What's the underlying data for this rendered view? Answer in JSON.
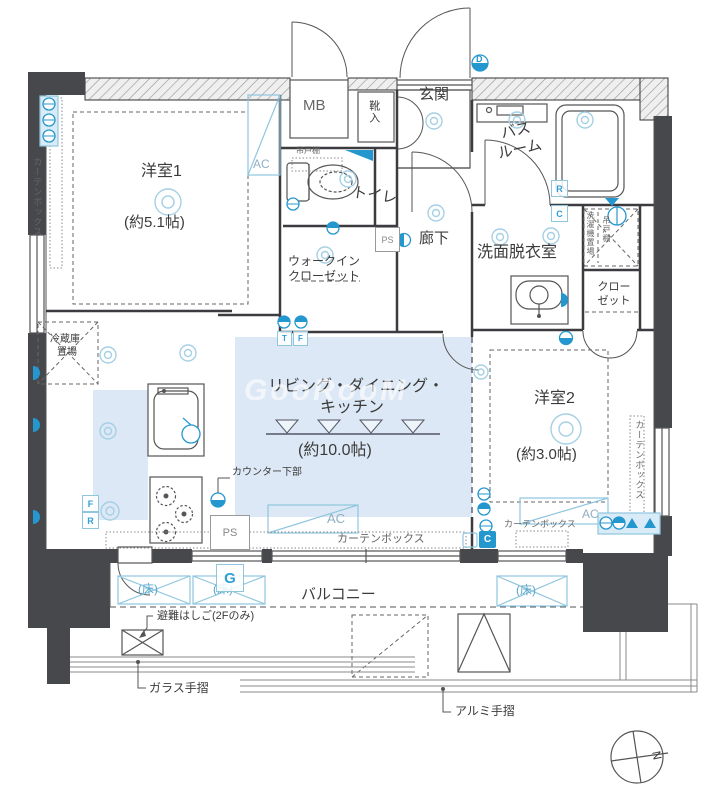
{
  "rooms": {
    "yoshitsu1": {
      "name": "洋室1",
      "size": "(約5.1帖)"
    },
    "yoshitsu2": {
      "name": "洋室2",
      "size": "(約3.0帖)"
    },
    "ldk": {
      "line1": "リビング・ダイニング・",
      "line2": "キッチン",
      "size": "(約10.0帖)"
    },
    "bath": {
      "line1": "バス",
      "line2": "ルーム"
    },
    "washroom": {
      "name": "洗面脱衣室"
    },
    "toilet": {
      "name": "トイレ"
    },
    "hall": {
      "name": "廊下"
    },
    "entrance": {
      "name": "玄関"
    },
    "wic": {
      "line1": "ウォークイン",
      "line2": "クローゼット"
    },
    "closet": {
      "line1": "クロー",
      "line2": "ゼット"
    },
    "balcony": {
      "name": "バルコニー"
    },
    "mb": {
      "name": "MB"
    },
    "shoe": {
      "name": "靴入"
    },
    "ps": {
      "name": "PS"
    }
  },
  "annotations": {
    "curtain_box": "カーテンボックス",
    "hanging_shelf": "吊戸棚",
    "washer_space": "洗濯機置場",
    "fridge": {
      "line1": "冷蔵庫",
      "line2": "置場"
    },
    "counter_lower": "カウンター下部",
    "escape_ladder": "避難はしご(2Fのみ)",
    "glass_rail": "ガラス手摺",
    "alumi_rail": "アルミ手摺",
    "floor_mark": "(床)",
    "ac": "AC"
  },
  "markers": {
    "g": "G",
    "r": "R",
    "c": "C",
    "t": "T",
    "f": "F",
    "d": "D"
  },
  "compass": {
    "north": "N"
  },
  "watermark": "GooRooM",
  "colors": {
    "wall": "#47484c",
    "accent_blue": "#2597cf",
    "room_fill": "#dce8f5",
    "symbol_outline": "#8fc6de"
  }
}
